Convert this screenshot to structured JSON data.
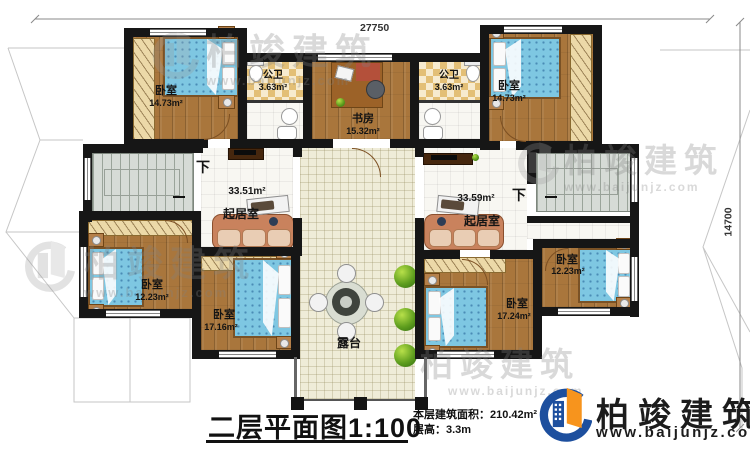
{
  "dimensions": {
    "top": "27750",
    "right": "14700"
  },
  "rooms": [
    {
      "id": "bedroom-top-left",
      "name": "卧室",
      "area": "14.73m²"
    },
    {
      "id": "bathroom-left",
      "name": "公卫",
      "area": "3.63m²"
    },
    {
      "id": "study",
      "name": "书房",
      "area": "15.32m²"
    },
    {
      "id": "bathroom-right",
      "name": "公卫",
      "area": "3.63m²"
    },
    {
      "id": "bedroom-top-right",
      "name": "卧室",
      "area": "14.73m²"
    },
    {
      "id": "living-room-left",
      "name": "起居室",
      "area": "33.51m²"
    },
    {
      "id": "living-room-right",
      "name": "起居室",
      "area": "33.59m²"
    },
    {
      "id": "bedroom-bottom-left",
      "name": "卧室",
      "area": "12.23m²"
    },
    {
      "id": "bedroom-bottom-midleft",
      "name": "卧室",
      "area": "17.16m²"
    },
    {
      "id": "terrace",
      "name": "露台"
    },
    {
      "id": "bedroom-bottom-midright",
      "name": "卧室",
      "area": "17.24m²"
    },
    {
      "id": "bedroom-bottom-right",
      "name": "卧室",
      "area": "12.23m²"
    }
  ],
  "stairs": {
    "down_label": "下"
  },
  "titleblock": {
    "title": "二层平面图",
    "scale": "1:100",
    "area_label": "本层建筑面积：",
    "area_value": "210.42m²",
    "height_label": "层高：",
    "height_value": "3.3m"
  },
  "logo": {
    "brand": "柏竣建筑",
    "url": "www.baijunjz.com"
  },
  "watermark": {
    "brand": "柏竣建筑",
    "url": "www.baijunjz.com"
  },
  "colors": {
    "wall": "#161616",
    "wood_floor": "#a9763c",
    "bath_tile": "#e3bf76",
    "hall_tile": "#efecd8",
    "stair": "#d6dbd6",
    "bed_blue": "#7ec7e2",
    "sofa": "#c9825d",
    "bush_green": "#5f9e1e",
    "logo_blue": "#1d4f9e",
    "logo_orange": "#f7941d"
  }
}
